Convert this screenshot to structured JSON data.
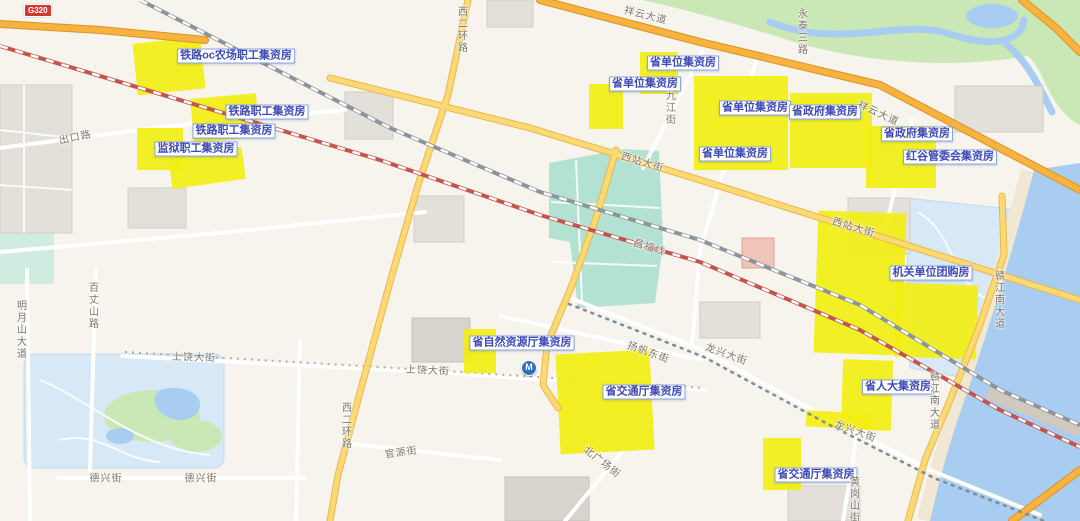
{
  "map": {
    "badge": {
      "text": "G320"
    },
    "metro_glyph": "M",
    "colors": {
      "background": "#f7f4ee",
      "parcel": "#f2ee15",
      "water": "#a8cdf0",
      "bluepark": "#d7e8f6",
      "park": "#c9e8b5",
      "station": "#b3e1d2",
      "sand": "#f1e8d3",
      "arterial": "#fcd975",
      "arterial-casing": "#e8b84b",
      "highway": "#f7b23f",
      "highway-casing": "#db9426",
      "railway-red": "#c4554e",
      "building": "#e3e0da",
      "label-border": "#8aa5e6",
      "label-text": "#3f4ab8",
      "road-label-text": "#7b7466",
      "badge-bg": "#d23a2f"
    },
    "parcel_labels": [
      {
        "text": "铁路oc农场职工集资房",
        "x": 236,
        "y": 56
      },
      {
        "text": "铁路职工集资房",
        "x": 267,
        "y": 112
      },
      {
        "text": "铁路职工集资房",
        "x": 234,
        "y": 131
      },
      {
        "text": "监狱职工集资房",
        "x": 196,
        "y": 149
      },
      {
        "text": "省单位集资房",
        "x": 683,
        "y": 63
      },
      {
        "text": "省单位集资房",
        "x": 645,
        "y": 84
      },
      {
        "text": "省单位集资房",
        "x": 755,
        "y": 108
      },
      {
        "text": "省政府集资房",
        "x": 825,
        "y": 112
      },
      {
        "text": "省单位集资房",
        "x": 735,
        "y": 154
      },
      {
        "text": "省政府集资房",
        "x": 917,
        "y": 134
      },
      {
        "text": "红谷管委会集资房",
        "x": 950,
        "y": 157
      },
      {
        "text": "机关单位团购房",
        "x": 931,
        "y": 273
      },
      {
        "text": "省自然资源厅集资房",
        "x": 522,
        "y": 343
      },
      {
        "text": "省交通厅集资房",
        "x": 644,
        "y": 392
      },
      {
        "text": "省人大集资房",
        "x": 898,
        "y": 387
      },
      {
        "text": "省交通厅集资房",
        "x": 816,
        "y": 475
      }
    ],
    "road_labels": [
      {
        "text": "出口路",
        "x": 75,
        "y": 136,
        "rot": -12
      },
      {
        "text": "明月山大道",
        "x": 20,
        "y": 330,
        "vertical": true
      },
      {
        "text": "百丈山路",
        "x": 92,
        "y": 306,
        "vertical": true
      },
      {
        "text": "上饶大街",
        "x": 194,
        "y": 356,
        "rot": 2
      },
      {
        "text": "上饶大街",
        "x": 428,
        "y": 369,
        "rot": 3
      },
      {
        "text": "德兴街",
        "x": 106,
        "y": 477,
        "rot": 0
      },
      {
        "text": "德兴街",
        "x": 201,
        "y": 477,
        "rot": 0
      },
      {
        "text": "官源街",
        "x": 401,
        "y": 451,
        "rot": -8
      },
      {
        "text": "北广场街",
        "x": 603,
        "y": 461,
        "rot": 38
      },
      {
        "text": "西二环路",
        "x": 345,
        "y": 426,
        "vertical": true
      },
      {
        "text": "西二环路",
        "x": 461,
        "y": 30,
        "vertical": true
      },
      {
        "text": "九江街",
        "x": 669,
        "y": 108,
        "vertical": true
      },
      {
        "text": "西站大街",
        "x": 643,
        "y": 161,
        "rot": 17
      },
      {
        "text": "西站大街",
        "x": 854,
        "y": 226,
        "rot": 17
      },
      {
        "text": "祥云大道",
        "x": 646,
        "y": 14,
        "rot": 14
      },
      {
        "text": "祥云大道",
        "x": 879,
        "y": 112,
        "rot": 25
      },
      {
        "text": "昌福线",
        "x": 650,
        "y": 246,
        "rot": 17
      },
      {
        "text": "扬帆东街",
        "x": 649,
        "y": 351,
        "rot": 20
      },
      {
        "text": "龙兴大街",
        "x": 727,
        "y": 353,
        "rot": 20
      },
      {
        "text": "龙兴大街",
        "x": 856,
        "y": 430,
        "rot": 20
      },
      {
        "text": "赣江南大道",
        "x": 998,
        "y": 300,
        "vertical": true
      },
      {
        "text": "赣江南大道",
        "x": 933,
        "y": 401,
        "vertical": true
      },
      {
        "text": "永泰三路",
        "x": 801,
        "y": 32,
        "vertical": true
      },
      {
        "text": "黄岗山街",
        "x": 853,
        "y": 500,
        "vertical": true
      }
    ],
    "parcels": [
      {
        "x": 135,
        "y": 40,
        "w": 68,
        "h": 52,
        "rot": -6
      },
      {
        "x": 192,
        "y": 96,
        "w": 66,
        "h": 44,
        "rot": -5
      },
      {
        "x": 137,
        "y": 128,
        "w": 46,
        "h": 42,
        "rot": 0
      },
      {
        "x": 170,
        "y": 152,
        "w": 74,
        "h": 32,
        "rot": -8
      },
      {
        "x": 640,
        "y": 52,
        "w": 38,
        "h": 42,
        "rot": 0
      },
      {
        "x": 589,
        "y": 84,
        "w": 34,
        "h": 45,
        "rot": 0
      },
      {
        "x": 694,
        "y": 76,
        "w": 94,
        "h": 94,
        "rot": 0
      },
      {
        "x": 790,
        "y": 93,
        "w": 82,
        "h": 75,
        "rot": 0
      },
      {
        "x": 866,
        "y": 126,
        "w": 70,
        "h": 62,
        "rot": 0
      },
      {
        "x": 816,
        "y": 212,
        "w": 88,
        "h": 142,
        "rot": 2
      },
      {
        "x": 895,
        "y": 284,
        "w": 82,
        "h": 74,
        "rot": 2
      },
      {
        "x": 842,
        "y": 360,
        "w": 50,
        "h": 70,
        "rot": 2
      },
      {
        "x": 806,
        "y": 412,
        "w": 66,
        "h": 16,
        "rot": 3
      },
      {
        "x": 464,
        "y": 329,
        "w": 32,
        "h": 44,
        "rot": 0
      },
      {
        "x": 558,
        "y": 352,
        "w": 94,
        "h": 100,
        "rot": -3
      },
      {
        "x": 763,
        "y": 438,
        "w": 38,
        "h": 52,
        "rot": 0
      }
    ]
  }
}
